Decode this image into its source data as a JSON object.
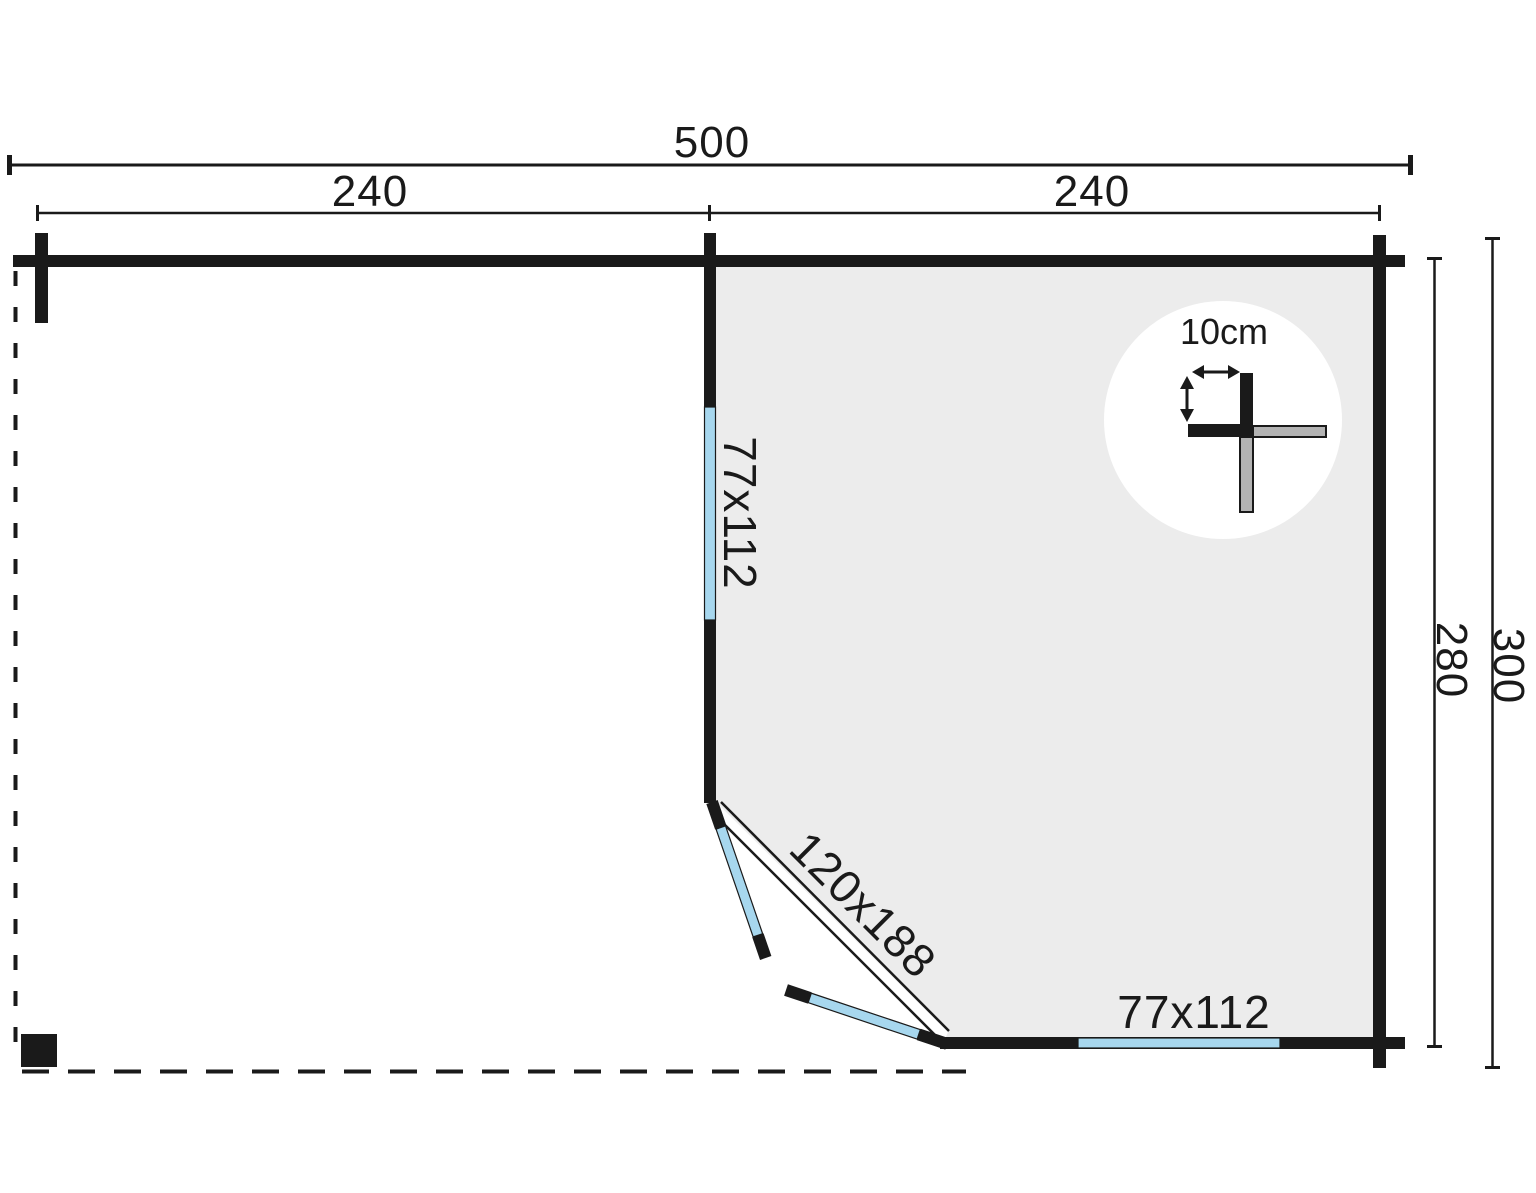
{
  "figure": {
    "type": "floor-plan",
    "dimensions": {
      "total_width": "500",
      "left_section_width": "240",
      "right_section_width": "240",
      "inner_depth": "280",
      "total_depth": "300"
    },
    "labels": {
      "side_window": "77x112",
      "door": "120x188",
      "front_window": "77x112",
      "wall_thickness": "10cm"
    },
    "colors": {
      "ink": "#1a1a1a",
      "room_fill": "#ececec",
      "glass_blue": "#a7d7ee",
      "log_gray": "#b3b3b3",
      "callout_bg": "#ffffff"
    }
  }
}
